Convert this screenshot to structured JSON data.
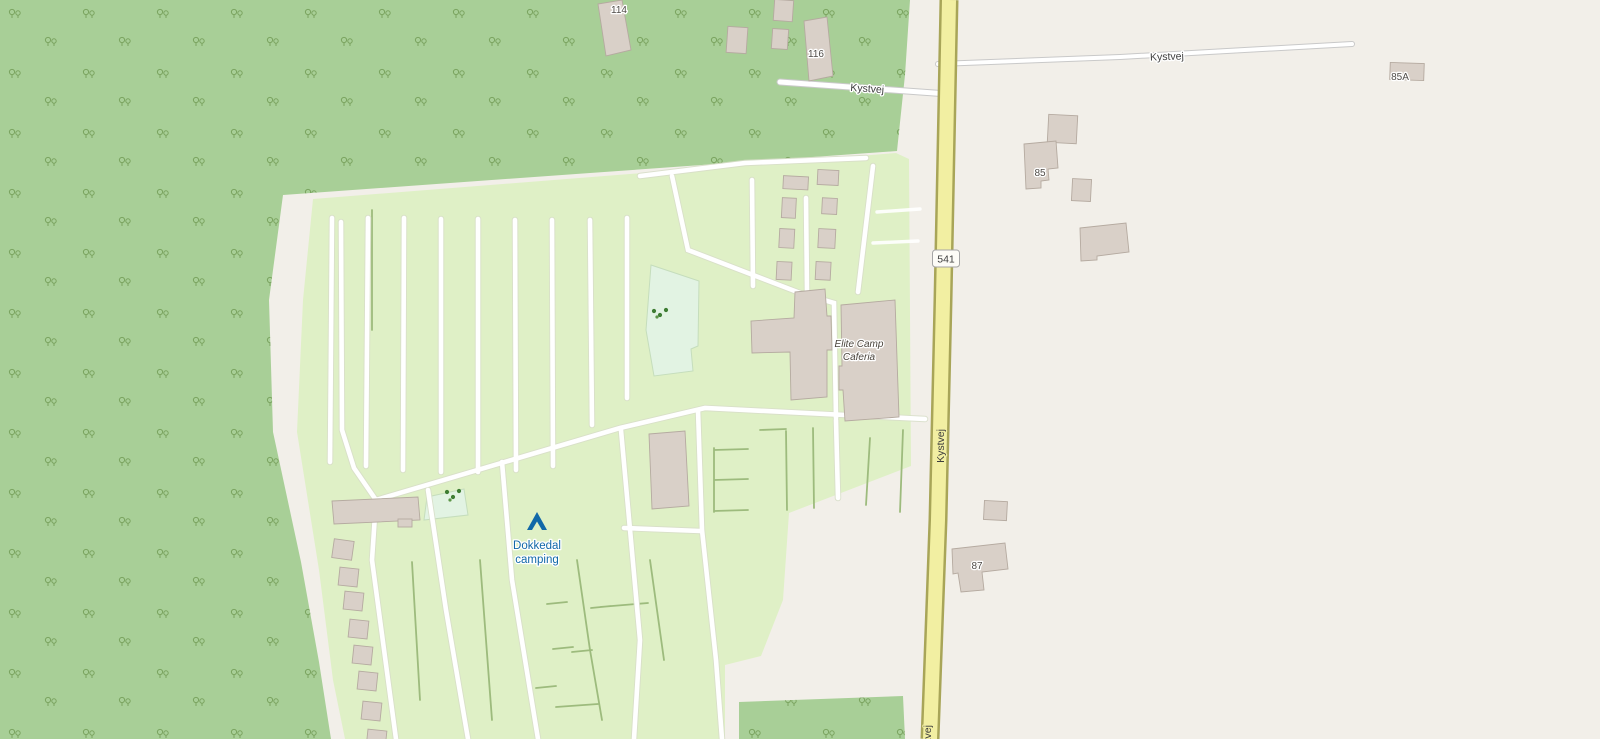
{
  "map": {
    "labels": {
      "route_shield": "541",
      "road_top": "Kystvej",
      "road_left": "Kystvej",
      "road_main_vertical": "Kystvej",
      "road_main_bottom": "Kystvej",
      "camp_site_line1": "Dokkedal",
      "camp_site_line2": "camping",
      "cafeteria_line1": "Elite Camp",
      "cafeteria_line2": "Caferia",
      "house_114": "114",
      "house_116": "116",
      "house_85": "85",
      "house_85A": "85A",
      "house_87": "87"
    },
    "colors": {
      "background": "#f2efe9",
      "forest": "#a8cf97",
      "scrub": "#7aa35f",
      "campsite": "#dff0c6",
      "mint": "#e2f3e3",
      "building": "#d9d0c8",
      "building_outline": "#b5aaa0",
      "road_primary": "#f2efa2",
      "road_primary_casing": "#a8a558",
      "road_white": "#ffffff",
      "road_white_casing": "#c9c9c9",
      "camp_path": "#ffffff",
      "hedge": "#9dbb7d",
      "tourism_blue": "#1168a8",
      "label_dark": "#4f4b47",
      "shield_bg": "#fdfcf7",
      "shield_border": "#a5a5a5",
      "tree": "#3e7d33"
    }
  }
}
